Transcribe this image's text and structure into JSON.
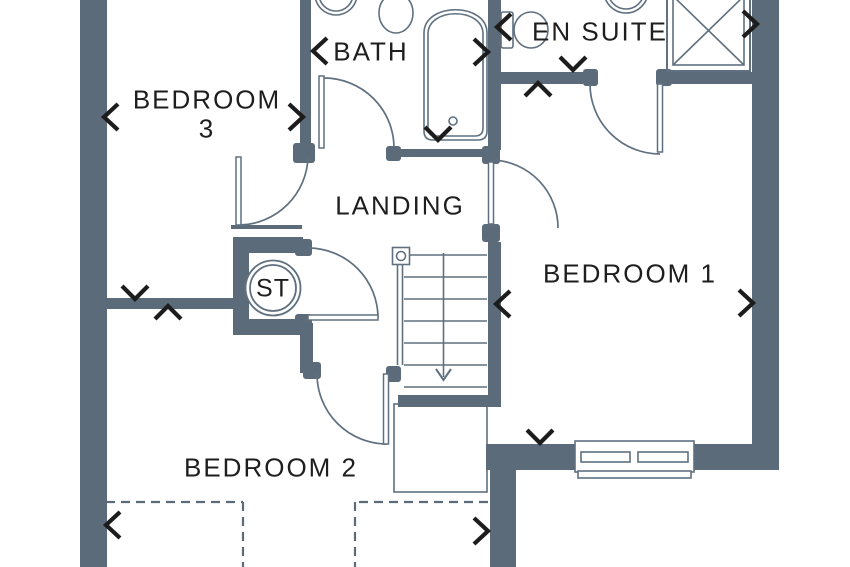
{
  "colors": {
    "wall": "#5b6b7a",
    "line": "#5f7080",
    "text": "#1e1e1e",
    "arrow": "#1c1c1c",
    "bg": "#ffffff"
  },
  "rooms": {
    "bedroom3": {
      "line1": "BEDROOM",
      "line2": "3"
    },
    "bath": {
      "label": "BATH"
    },
    "ensuite": {
      "label": "EN SUITE"
    },
    "landing": {
      "label": "LANDING"
    },
    "bedroom1": {
      "label": "BEDROOM 1"
    },
    "bedroom2": {
      "label": "BEDROOM 2"
    },
    "storage": {
      "label": "ST"
    }
  },
  "icons": {
    "fixtures": [
      "bathtub-icon",
      "toilet-icon",
      "sink-icon",
      "shower-icon",
      "staircase-icon",
      "storage-cylinder-icon",
      "door-arc-icon",
      "window-icon",
      "newel-post-icon",
      "stair-direction-arrow-icon"
    ],
    "dimension_markers": {
      "bedroom3": [
        "left",
        "right",
        "down"
      ],
      "bath": [
        "left",
        "right",
        "down"
      ],
      "ensuite": [
        "left",
        "right",
        "down"
      ],
      "bedroom1": [
        "up",
        "left",
        "right",
        "down"
      ],
      "bedroom2": [
        "up",
        "left",
        "right"
      ]
    },
    "dashed_outline_meaning": "restricted-head-height-area"
  }
}
